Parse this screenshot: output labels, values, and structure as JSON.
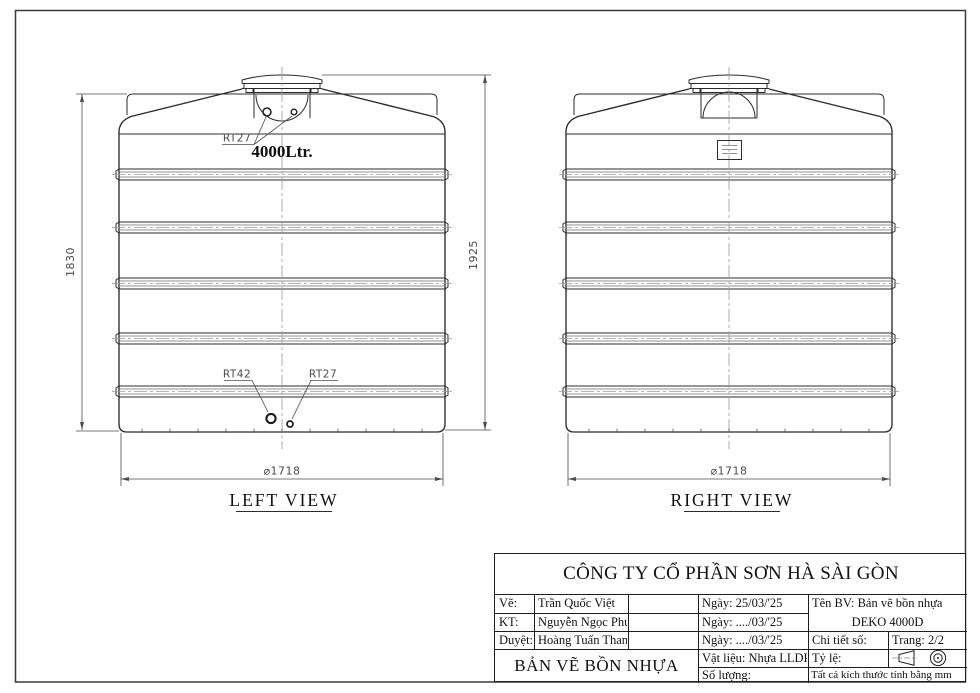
{
  "page": {
    "background": "#ffffff",
    "line_color": "#2b2b2b",
    "dim_color": "#4c4c4c",
    "centerline_color": "#9a9a9a"
  },
  "drawing": {
    "left_view": {
      "title": "LEFT  VIEW",
      "capacity": "4000Ltr.",
      "top_fitting_label": "RT27",
      "bottom_fitting_left_label": "RT42",
      "bottom_fitting_right_label": "RT27",
      "dim_height_shoulder": "1830",
      "dim_height_total": "1925",
      "dim_diameter": "⌀1718"
    },
    "right_view": {
      "title": "RIGHT VIEW",
      "dim_diameter": "⌀1718"
    }
  },
  "title_block": {
    "company": "CÔNG TY CỔ PHẦN SƠN HÀ SÀI GÒN",
    "rows": [
      {
        "label": "Vẽ:",
        "name": "Trần Quốc Việt",
        "date": "Ngày: 25/03/'25"
      },
      {
        "label": "KT:",
        "name": "Nguyễn Ngọc Phú",
        "date": "Ngày: ..../03/'25"
      },
      {
        "label": "Duyệt:",
        "name": "Hoàng Tuấn Thanh",
        "date": "Ngày: ..../03/'25"
      }
    ],
    "ten_bv_line1": "Tên BV: Bản vẽ bồn nhựa",
    "ten_bv_line2": "DEKO 4000D",
    "chi_tiet_so": "Chi tiết số:",
    "trang": "Trang: 2/2",
    "drawing_title": "BẢN VẼ BỒN NHỰA",
    "material": "Vật liệu: Nhựa LLDPE",
    "ty_le": "Tỷ lệ:",
    "so_luong": "Số lượng:",
    "note": "Tất cả kích thước tính bằng mm"
  }
}
